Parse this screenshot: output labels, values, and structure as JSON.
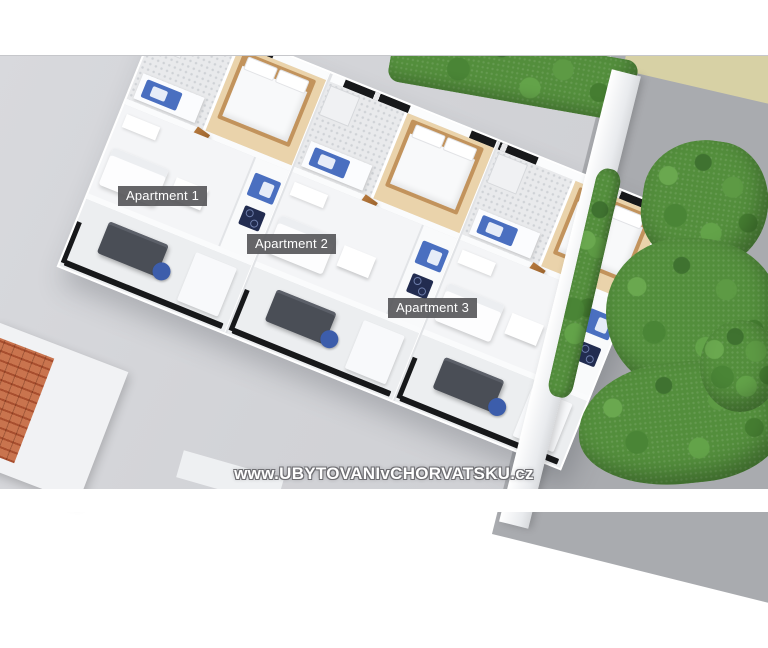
{
  "scene": {
    "description": "3D aerial rendering of a floor plan with three ground-floor apartments, terraces, garden wall, trees and pavement",
    "apartment_labels": [
      {
        "text": "Apartment 1"
      },
      {
        "text": "Apartment 2"
      },
      {
        "text": "Apartment 3"
      }
    ],
    "watermark": "www.UBYTOVANIvCHORVATSKU.cz",
    "colors": {
      "pavement_light": "#d2d3d7",
      "pavement_dark": "#a9abaf",
      "sand": "#d7d1a5",
      "foliage": "#538e3c",
      "wall_white": "#f2f3f5",
      "wood_door": "#b5783c",
      "wood_bed": "#c2935c",
      "wood_floor": "#ead3ab",
      "fixture_blue": "#4a6fc0",
      "cooktop_navy": "#222c50",
      "terrace_table": "#4a4e56",
      "railing_black": "#17181a",
      "roof_terracotta": "#c9744e",
      "label_bg": "rgba(84,84,88,0.9)",
      "label_text": "#ffffff"
    }
  }
}
